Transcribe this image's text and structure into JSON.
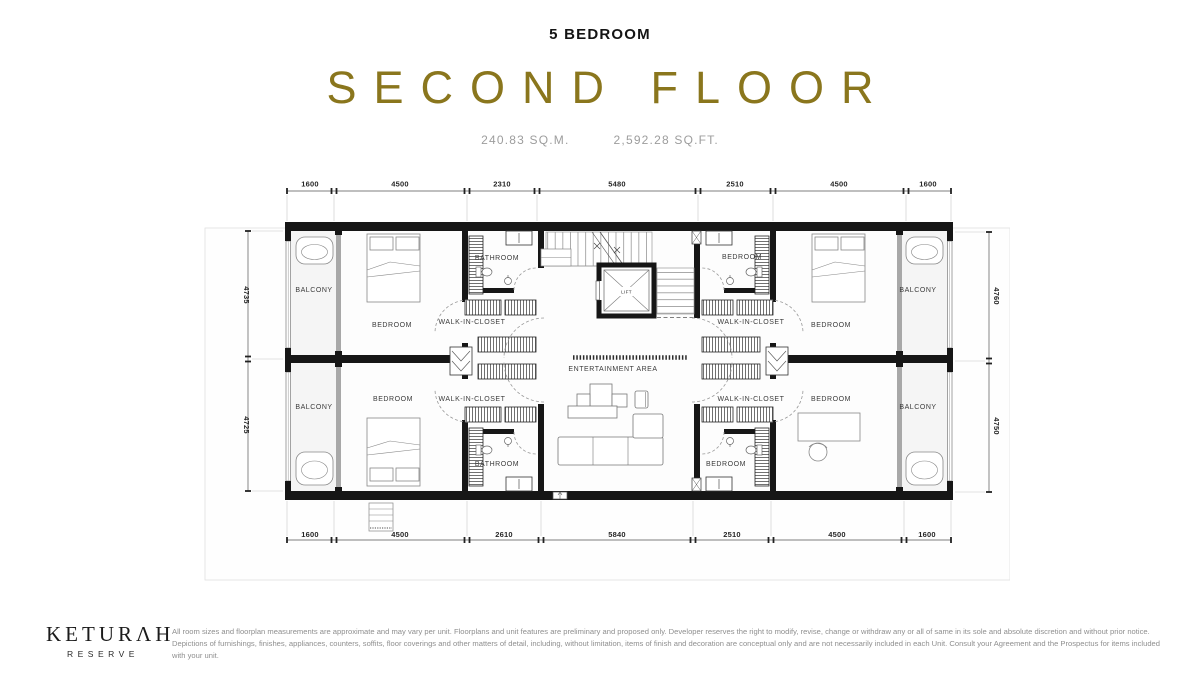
{
  "header": {
    "unit_type": "5 BEDROOM",
    "title": "SECOND FLOOR",
    "area_sqm": "240.83 SQ.M.",
    "area_sqft": "2,592.28 SQ.FT.",
    "title_color": "#8a761d"
  },
  "floorplan": {
    "labels": {
      "balcony": "BALCONY",
      "bedroom": "BEDROOM",
      "bathroom": "BATHROOM",
      "walk_in_closet": "WALK-IN-CLOSET",
      "entertainment_area": "ENTERTAINMENT AREA",
      "lift": "LIFT"
    },
    "dimensions": {
      "top": [
        "1600",
        "4500",
        "2310",
        "5480",
        "2510",
        "4500",
        "1600"
      ],
      "bottom": [
        "1600",
        "4500",
        "2610",
        "5840",
        "2510",
        "4500",
        "1600"
      ],
      "left": [
        "4735",
        "4725"
      ],
      "right": [
        "4760",
        "4750"
      ]
    }
  },
  "footer": {
    "brand": "KETURΛH",
    "brand_sub": "RESERVE",
    "disclaimer_line1": "All room sizes and floorplan measurements are approximate and may vary per unit. Floorplans and unit features are preliminary and proposed only. Developer reserves the right to modify, revise, change or withdraw any or all of same in its sole and absolute discretion and without prior notice.",
    "disclaimer_line2": "Depictions of furnishings, finishes, appliances, counters, soffits, floor coverings and other matters of detail, including, without limitation, items of finish and decoration are conceptual only and are not necessarily included in each Unit. Consult your Agreement and the Prospectus for items included with your unit."
  }
}
